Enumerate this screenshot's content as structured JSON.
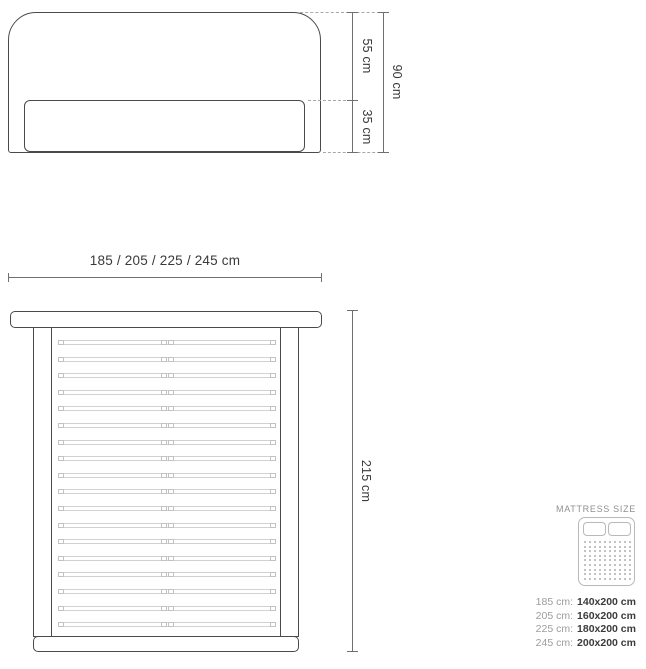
{
  "front_view": {
    "dim_headboard_upper": "55 cm",
    "dim_base_height": "35 cm",
    "dim_total_height": "90 cm"
  },
  "plan_view": {
    "dim_width_options": "185 / 205 / 225 / 245 cm",
    "dim_length": "215 cm",
    "slat_rows": 18
  },
  "legend": {
    "title": "MATTRESS SIZE",
    "icon": "mattress-top-view-icon",
    "sizes": [
      {
        "frame": "185 cm:",
        "mattress": "140x200 cm"
      },
      {
        "frame": "205 cm:",
        "mattress": "160x200 cm"
      },
      {
        "frame": "225 cm:",
        "mattress": "180x200 cm"
      },
      {
        "frame": "245 cm:",
        "mattress": "200x200 cm"
      }
    ],
    "dots_rows": 9,
    "dots_cols": 10
  },
  "colors": {
    "outline": "#4a4a4a",
    "slat": "#d2d2d2",
    "dimension": "#707070",
    "text": "#3a3a3a",
    "muted": "#9c9c9c"
  }
}
